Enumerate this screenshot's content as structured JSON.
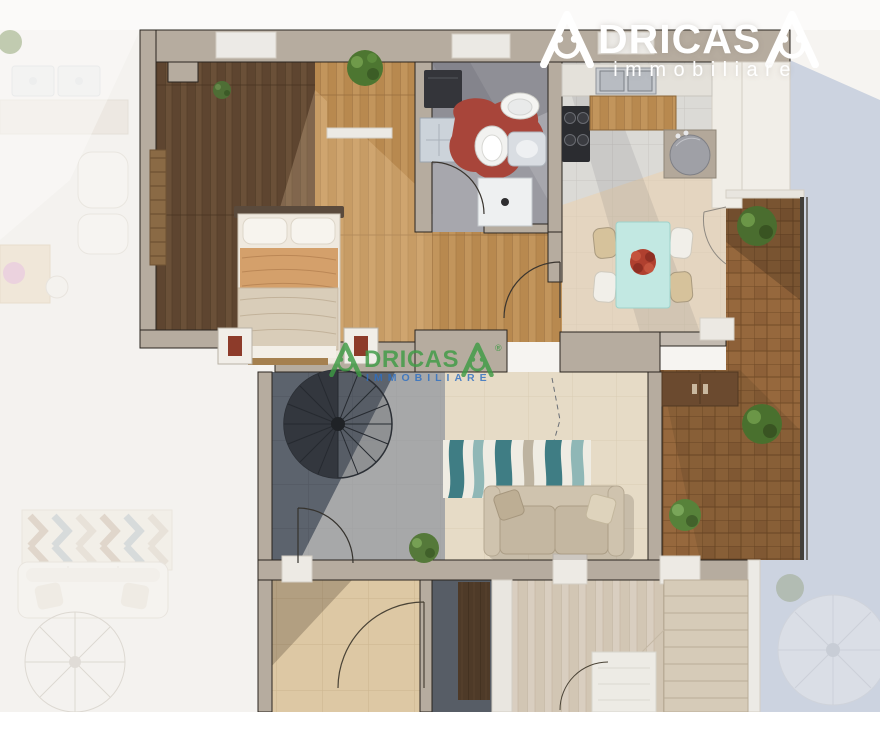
{
  "brand": {
    "name": "ADRICASA",
    "top_watermark_color": "#ffffff",
    "center_watermark_color": "#3f9b45",
    "center_tagline_color": "#2e6fc2"
  },
  "watermarks": {
    "top": {
      "brand_mid": "DRICAS",
      "tagline": "immobiliare"
    },
    "center": {
      "brand_mid": "DRICAS",
      "tagline": "IMMOBILIARE",
      "registered": "®"
    }
  },
  "floorplan": {
    "description": "3D rendered top-down apartment floor plan (real-estate listing image)",
    "rooms": [
      "bedroom",
      "bathroom",
      "kitchen",
      "dining-area",
      "entry-hall",
      "living-room",
      "balcony-terrace",
      "lower-room-left",
      "lower-room-center",
      "staircase-room",
      "adjacent-unit-faded-left",
      "adjacent-unit-faded-bottom-right"
    ],
    "furniture": [
      "double-bed",
      "nightstand",
      "wall-plant",
      "washing-machine",
      "bathroom-sink",
      "toilet",
      "bidet",
      "shower",
      "red-bath-rug",
      "kitchen-sink",
      "gas-hob",
      "wood-counter",
      "kitchen-island",
      "dining-table",
      "dining-chairs",
      "flower-centerpiece",
      "sofa",
      "striped-rug",
      "spiral-staircase",
      "straight-staircase",
      "wardrobe",
      "potted-plants",
      "door-swings"
    ],
    "palette": {
      "wall": "#b6ac9f",
      "wall_outline": "#2a251f",
      "dark_wood_floor": "#5e4530",
      "honey_wood_floor": "#b8894f",
      "bathroom_floor": "#8f8f96",
      "kitchen_tile": "#dbdad6",
      "dining_beige": "#e6d8bf",
      "living_slate": "#5c636d",
      "living_beige": "#e6dbc6",
      "balcony_tile": "#96683d",
      "stone_beige": "#ddc8a4",
      "light_wood": "#d2c6b4",
      "shadow_blue": "#ccd3e0",
      "table_teal": "#c2e8e2",
      "accent_red": "#a8453a",
      "plant_green": "#4d7631"
    }
  }
}
